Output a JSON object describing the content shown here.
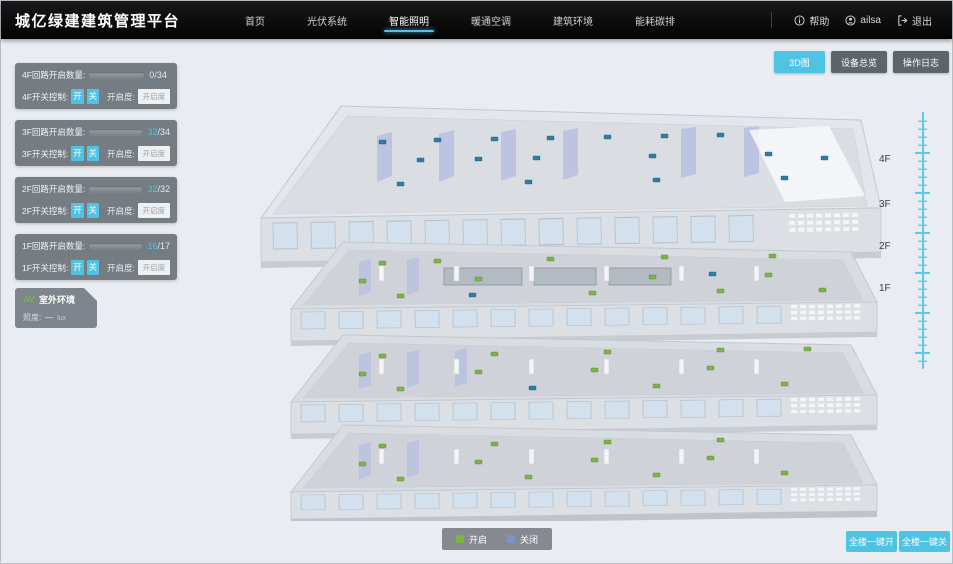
{
  "colors": {
    "accent": "#4fc3e4",
    "on_green": "#7cb544",
    "off_blue": "#7b93c9",
    "marker_off": "#2f7da3"
  },
  "header": {
    "title": "城亿绿建建筑管理平台",
    "nav": [
      {
        "label": "首页"
      },
      {
        "label": "光伏系统"
      },
      {
        "label": "智能照明"
      },
      {
        "label": "暖通空调"
      },
      {
        "label": "建筑环境"
      },
      {
        "label": "能耗碳排"
      }
    ],
    "help": "帮助",
    "user": "ailsa",
    "logout": "退出"
  },
  "panels": [
    {
      "count_label": "4F回路开启数量:",
      "num": "0",
      "den": "/34",
      "pct": 0,
      "switch_label": "4F开关控制:",
      "on": "开",
      "off": "关",
      "dim_label": "开启度:",
      "dim_placeholder": "开启度",
      "unit": "%"
    },
    {
      "count_label": "3F回路开启数量:",
      "num": "32",
      "den": "/34",
      "pct": 94,
      "switch_label": "3F开关控制:",
      "on": "开",
      "off": "关",
      "dim_label": "开启度:",
      "dim_placeholder": "开启度",
      "unit": "%"
    },
    {
      "count_label": "2F回路开启数量:",
      "num": "32",
      "den": "/32",
      "pct": 100,
      "switch_label": "2F开关控制:",
      "on": "开",
      "off": "关",
      "dim_label": "开启度:",
      "dim_placeholder": "开启度",
      "unit": "%"
    },
    {
      "count_label": "1F回路开启数量:",
      "num": "16",
      "den": "/17",
      "pct": 94,
      "switch_label": "1F开关控制:",
      "on": "开",
      "off": "关",
      "dim_label": "开启度:",
      "dim_placeholder": "开启度",
      "unit": "%"
    }
  ],
  "outdoor": {
    "title": "室外环境",
    "metric_label": "照度:",
    "metric_value": "—",
    "metric_unit": "lux"
  },
  "view_tabs": [
    {
      "label": "3D图"
    },
    {
      "label": "设备总览"
    },
    {
      "label": "操作日志"
    }
  ],
  "floor_axis": [
    "4F",
    "3F",
    "2F",
    "1F"
  ],
  "legend": [
    {
      "label": "开启"
    },
    {
      "label": "关闭"
    }
  ],
  "bulk": [
    {
      "label": "全楼一键开"
    },
    {
      "label": "全楼一键关"
    }
  ]
}
